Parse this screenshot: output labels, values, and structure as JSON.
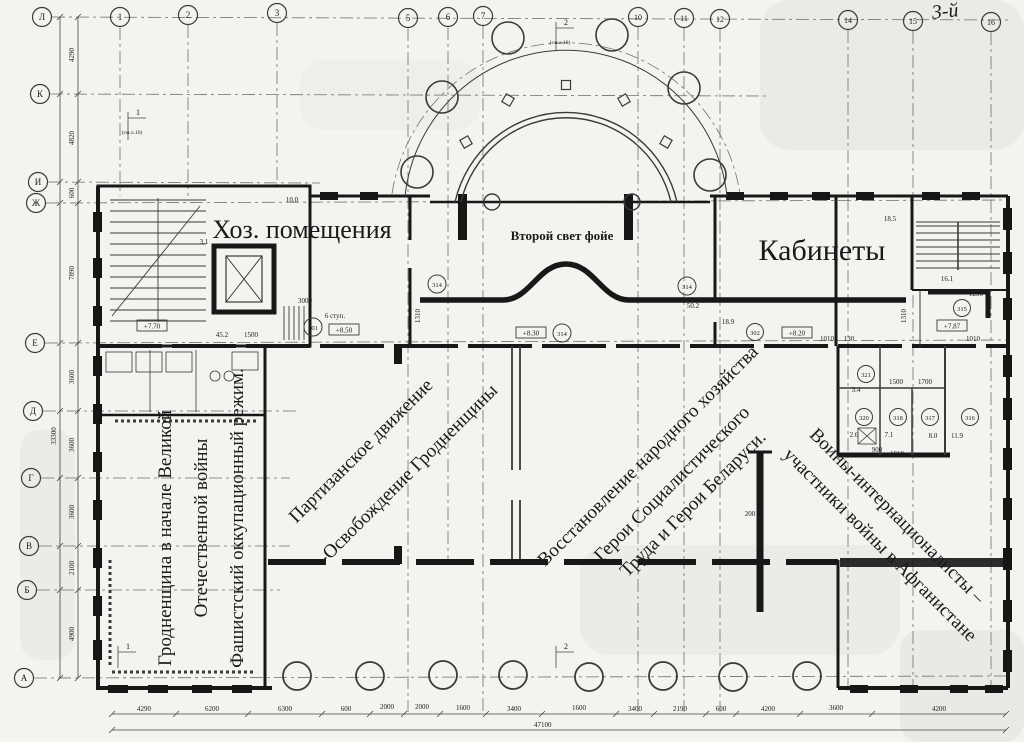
{
  "meta": {
    "floor_note": "3-й"
  },
  "grid": {
    "cols": [
      "1",
      "2",
      "3",
      "5",
      "6",
      "7",
      "10",
      "11",
      "12",
      "14",
      "15",
      "16"
    ],
    "rows": [
      "Л",
      "К",
      "И",
      "Ж",
      "Е",
      "Д",
      "Г",
      "В",
      "Б",
      "А"
    ]
  },
  "halls": {
    "hall1": [
      "Гродненщина в начале Великой",
      "Отечественной войны",
      "Фашистский оккупационный режим."
    ],
    "hall2": [
      "Партизанское движение",
      "-Освобождение Гродненщины"
    ],
    "hall3": [
      "Восстановление народного хозяйства",
      "Герои Социалистического",
      "Труда и Герои Беларуси."
    ],
    "hall4": [
      "Воины-интернационалисты –",
      "участники войны в Афганистане"
    ],
    "utility": "Хоз. помещения",
    "offices": "Кабинеты",
    "foyer": "Второй свет фойе"
  },
  "room_numbers": {
    "r301": "301",
    "r314a": "314",
    "r314b": "314",
    "r314c": "314",
    "r302": "302",
    "r315": "315",
    "r316": "316",
    "r317": "317",
    "r318": "318",
    "r320": "320",
    "r321": "321"
  },
  "elevations": {
    "e770": "+7.70",
    "e850": "+8.50",
    "e830": "+8.30",
    "e820": "+8.20",
    "e787": "+7.87"
  },
  "areas": {
    "a100": "10.0",
    "a31": "3.1",
    "a452": "45.2",
    "a502": "50.2",
    "a189": "18.9",
    "a185": "18.5",
    "a161": "16.1",
    "a34": "3.4",
    "a26": "2.6",
    "a71": "7.1",
    "a80": "8.0",
    "a119": "11.9"
  },
  "small_dims": {
    "d1500": "1500",
    "d3000": "3000",
    "d1290": "1290",
    "d1010a": "1010",
    "d1010b": "1010",
    "d1010c": "1010",
    "d130": "130",
    "d1500b": "1500",
    "d1700": "1700",
    "d900": "900",
    "d200": "200",
    "d1310a": "1310",
    "d1310b": "1310"
  },
  "notes": {
    "steps": "6 ступ.",
    "see_sheet": "(см.л.10)",
    "sec1": "1",
    "sec2": "2"
  },
  "dims": {
    "bottom": [
      "4290",
      "6200",
      "6300",
      "600",
      "2000",
      "2000",
      "1600",
      "3400",
      "1600",
      "3400",
      "2190",
      "600",
      "4200",
      "3600",
      "4200"
    ],
    "bottom_total": "47100",
    "left": [
      "4290",
      "4820",
      "600",
      "7890",
      "3600",
      "3600",
      "3600",
      "2100",
      "4900"
    ],
    "left_total": "33300"
  }
}
